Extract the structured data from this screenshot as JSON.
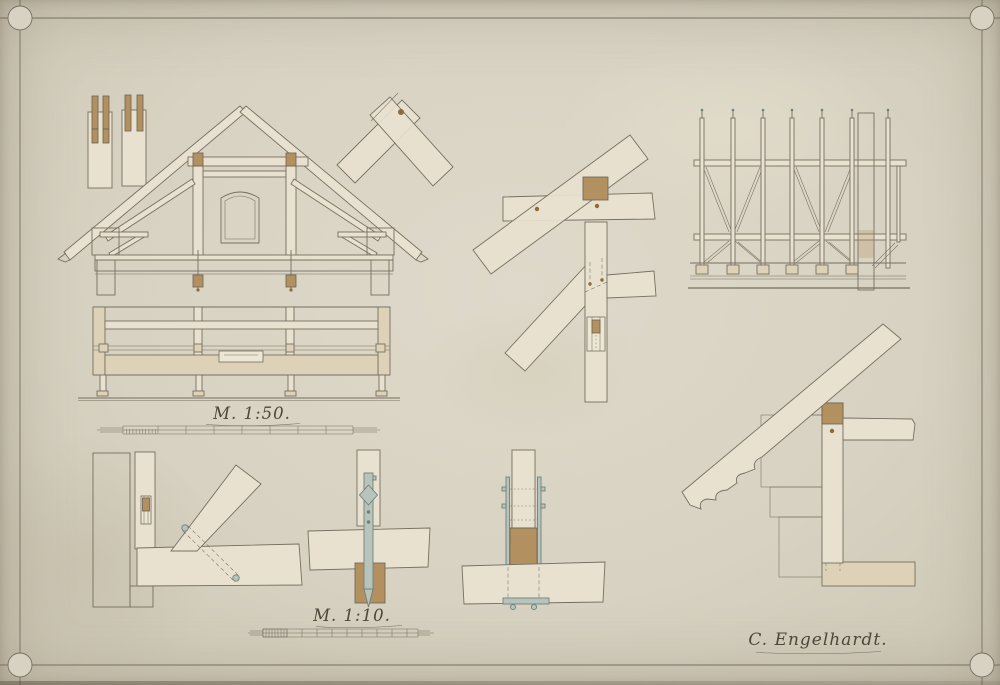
{
  "labels": {
    "scale_main": "M. 1:50.",
    "scale_detail": "M. 1:10.",
    "signature": "C. Engelhardt."
  },
  "colors": {
    "paper": "#d8d2c2",
    "paper-light": "#ded9ca",
    "paper-edge": "#cbc5b3",
    "ink": "#776f60",
    "ink-dark": "#6a6252",
    "ink-text": "#4e473a",
    "timber": "#e8e1cf",
    "timber2": "#ddd2b7",
    "oak": "#b3905f",
    "oak-dark": "#8d6b3f",
    "iron": "#b8c4bb",
    "iron-dark": "#70817a",
    "brick": "#ddd1b4"
  }
}
